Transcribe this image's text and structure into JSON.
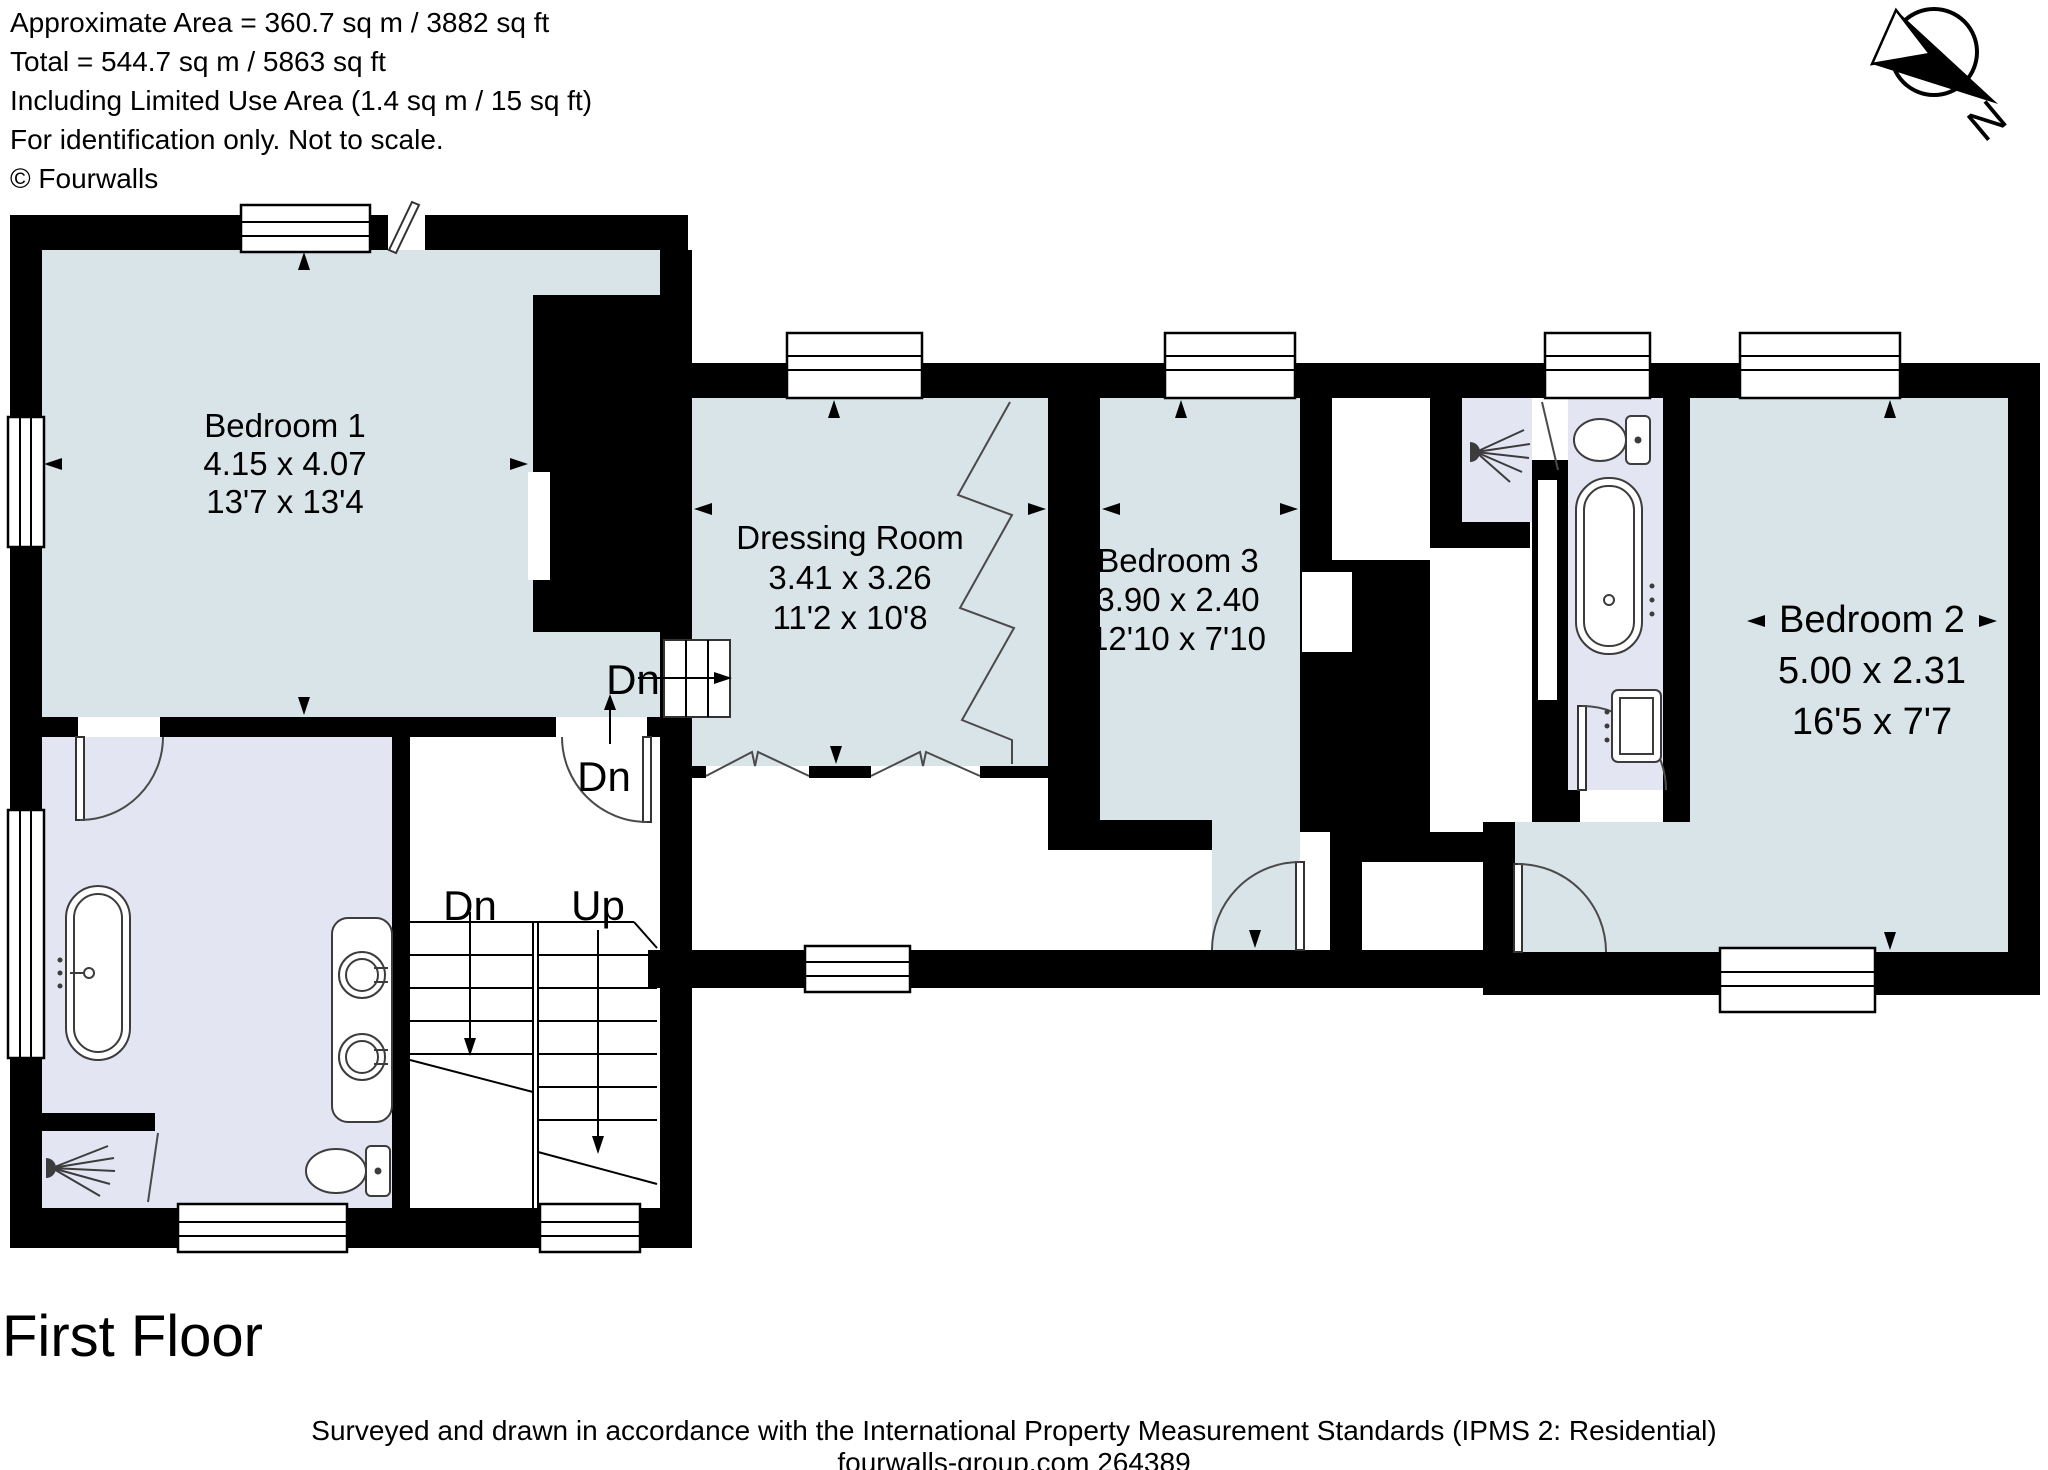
{
  "header": {
    "line1": "Approximate Area = 360.7 sq m / 3882 sq ft",
    "line2": "Total = 544.7 sq m / 5863 sq ft",
    "line3": "Including Limited Use Area (1.4 sq m / 15 sq ft)",
    "line4": "For identification only. Not to scale.",
    "line5": "© Fourwalls"
  },
  "compass": {
    "label": "N"
  },
  "rooms": {
    "bedroom1": {
      "name": "Bedroom 1",
      "metric": "4.15 x 4.07",
      "imperial": "13'7 x 13'4"
    },
    "dressing_room": {
      "name": "Dressing Room",
      "metric": "3.41 x 3.26",
      "imperial": "11'2 x 10'8"
    },
    "bedroom3": {
      "name": "Bedroom 3",
      "metric": "3.90 x 2.40",
      "imperial": "12'10 x 7'10"
    },
    "bedroom2": {
      "name": "Bedroom 2",
      "metric": "5.00 x 2.31",
      "imperial": "16'5 x 7'7"
    }
  },
  "stairs": {
    "down_label_landing": "Dn",
    "down_label_door": "Dn",
    "down_label_flight": "Dn",
    "up_label_flight": "Up"
  },
  "floor": {
    "title": "First Floor"
  },
  "footer": {
    "line1": "Surveyed and drawn in accordance with the International Property Measurement Standards (IPMS 2: Residential)",
    "line2": "fourwalls-group.com 264389"
  },
  "colors": {
    "wall": "#000000",
    "bedroom_fill": "#d9e4e9",
    "bathroom_fill": "#e3e6f2",
    "fixture_line": "#3c3c3c"
  }
}
